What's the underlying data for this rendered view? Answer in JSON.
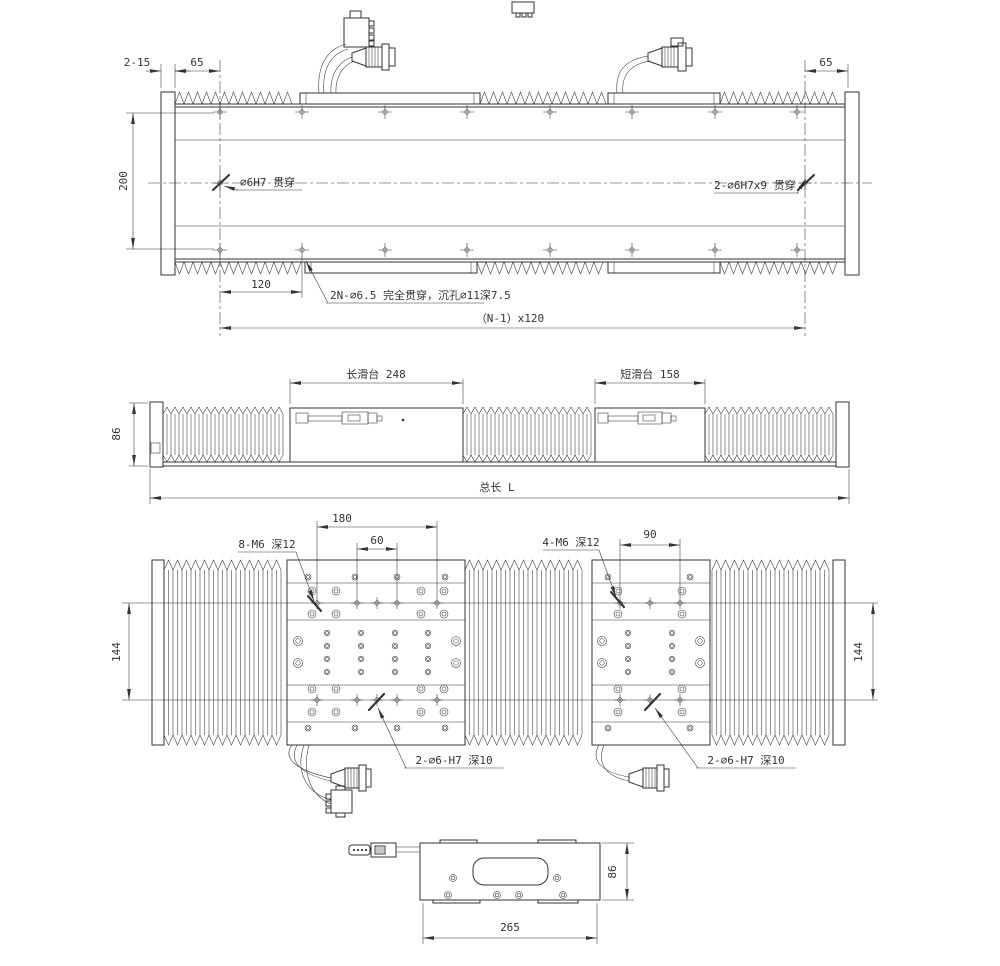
{
  "labels": {
    "plan": {
      "plate_thickness": "2-15",
      "offset_left": "65",
      "offset_right": "65",
      "height": "200",
      "pitch": "120",
      "pattern_length": "（N-1）x120",
      "dowel_left": "∅6H7 贯穿",
      "dowel_right": "2-∅6H7x9 贯穿",
      "mount_holes": "2N-∅6.5 完全贯穿，沉孔∅11深7.5"
    },
    "front": {
      "height": "86",
      "long_slide": "长滑台 248",
      "short_slide": "短滑台 158",
      "total_length": "总长 L"
    },
    "top": {
      "long_m6": "8-M6 深12",
      "long_span": "180",
      "long_inner": "60",
      "short_m6": "4-M6 深12",
      "short_span": "90",
      "width_left": "144",
      "width_right": "144",
      "long_dowel": "2-∅6-H7 深10",
      "short_dowel": "2-∅6-H7 深10"
    },
    "end": {
      "width": "265",
      "height": "86"
    }
  },
  "colors": {
    "line": "#333333",
    "background": "#ffffff"
  }
}
